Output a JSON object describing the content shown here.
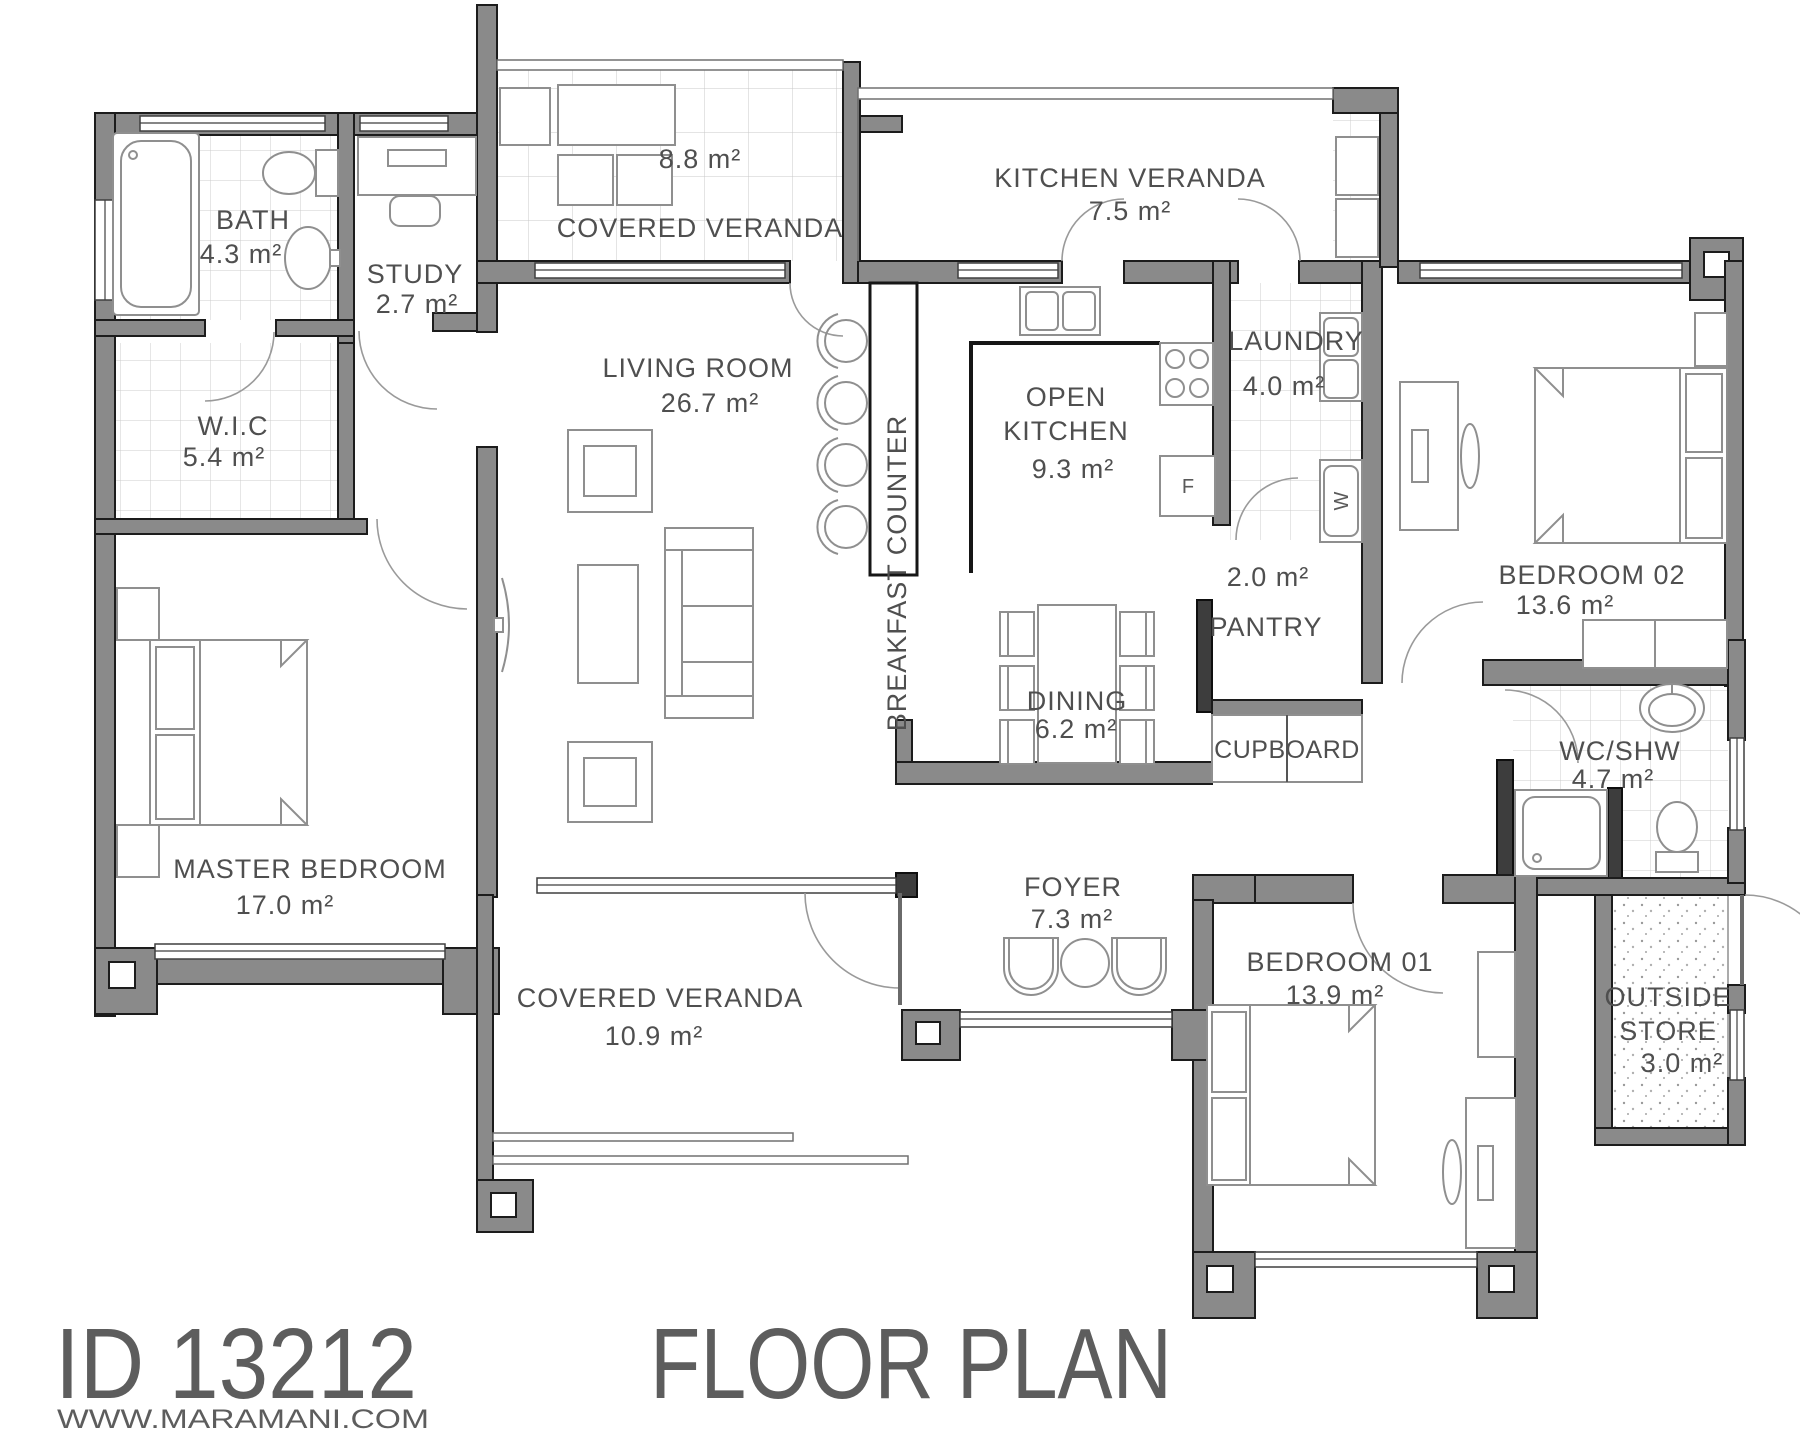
{
  "footer": {
    "plan_id": "ID 13212",
    "website": "WWW.MARAMANI.COM",
    "title": "FLOOR PLAN"
  },
  "rooms": {
    "bath": {
      "name": "BATH",
      "area": "4.3 m²"
    },
    "study": {
      "name": "STUDY",
      "area": "2.7 m²"
    },
    "wic": {
      "name": "W.I.C",
      "area": "5.4 m²"
    },
    "covered_veranda_top": {
      "name": "COVERED VERANDA",
      "area": "8.8 m²"
    },
    "kitchen_veranda": {
      "name": "KITCHEN VERANDA",
      "area": "7.5 m²"
    },
    "living_room": {
      "name": "LIVING ROOM",
      "area": "26.7 m²"
    },
    "breakfast_counter": {
      "name": "BREAKFAST COUNTER"
    },
    "open_kitchen": {
      "line1": "OPEN",
      "line2": "KITCHEN",
      "area": "9.3 m²"
    },
    "laundry": {
      "name": "LAUNDRY",
      "area": "4.0 m²"
    },
    "pantry": {
      "name": "PANTRY",
      "area": "2.0 m²"
    },
    "bedroom02": {
      "name": "BEDROOM 02",
      "area": "13.6 m²"
    },
    "dining": {
      "name": "DINING",
      "area": "6.2 m²"
    },
    "cupboard": {
      "name": "CUPBOARD"
    },
    "wc_shw": {
      "name": "WC/SHW",
      "area": "4.7 m²"
    },
    "master_bedroom": {
      "name": "MASTER BEDROOM",
      "area": "17.0 m²"
    },
    "covered_veranda_bottom": {
      "name": "COVERED VERANDA",
      "area": "10.9 m²"
    },
    "foyer": {
      "name": "FOYER",
      "area": "7.3 m²"
    },
    "bedroom01": {
      "name": "BEDROOM 01",
      "area": "13.9 m²"
    },
    "outside_store": {
      "line1": "OUTSIDE",
      "line2": "STORE",
      "area": "3.0 m²"
    }
  },
  "appliances": {
    "fridge": "F",
    "washer": "W"
  },
  "colors": {
    "wall": "#8a8a8a",
    "wall_dark": "#3d3d3d",
    "text": "#4f4f4f",
    "tile": "#cccccc"
  }
}
